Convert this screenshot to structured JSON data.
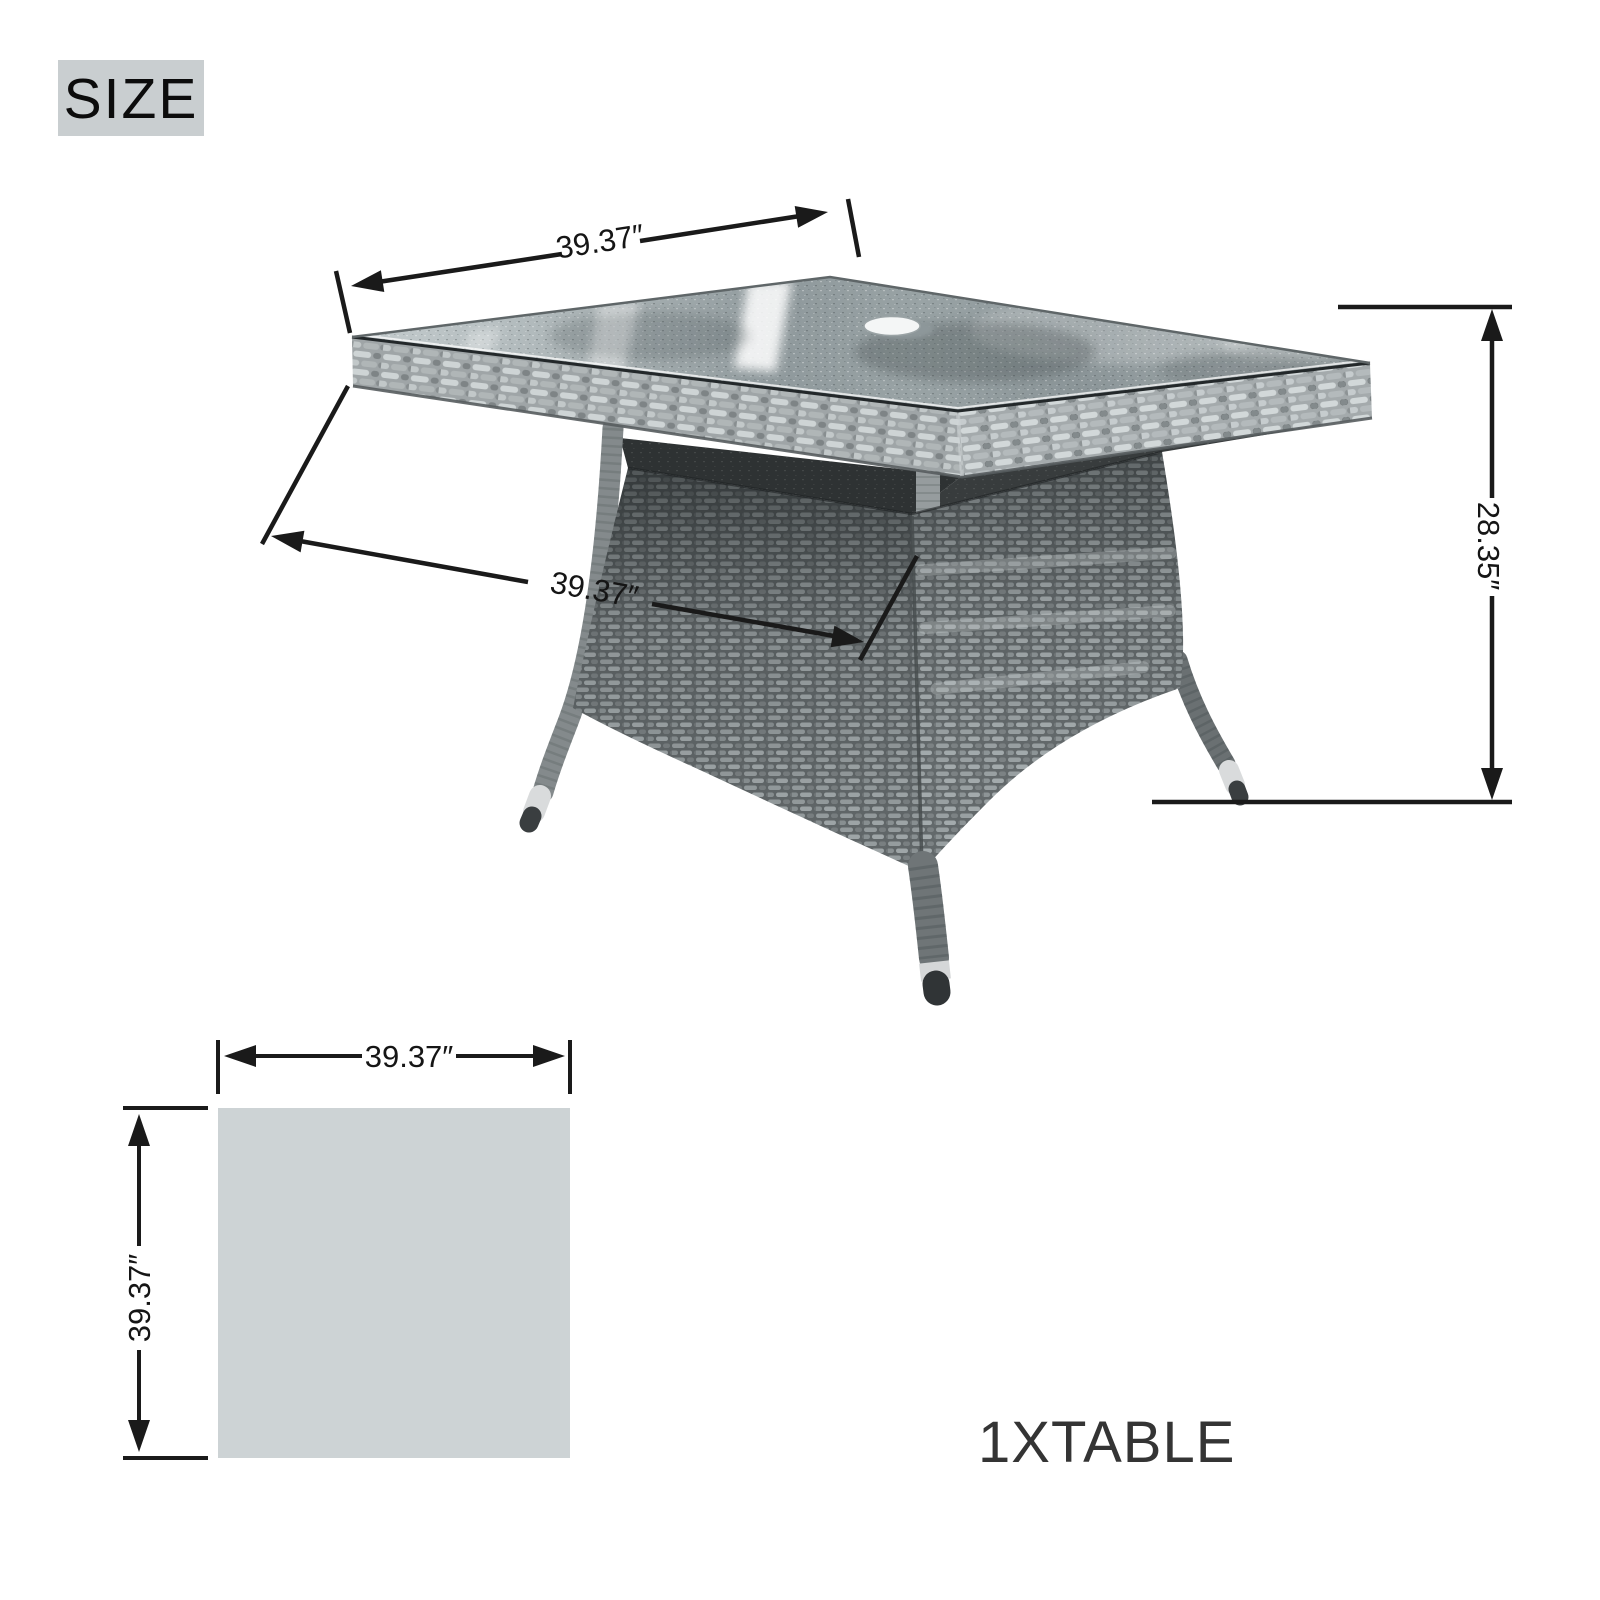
{
  "badge": {
    "label": "SIZE"
  },
  "product": {
    "note": "1XTABLE"
  },
  "dimensions": {
    "table_width": "39.37″",
    "table_depth": "39.37″",
    "table_height": "28.35″",
    "plan_width": "39.37″",
    "plan_depth": "39.37″"
  },
  "colors": {
    "dimension_lines": "#1a1a1a",
    "badge_background": "#c9ced0",
    "plan_square_fill": "#cdd3d5",
    "wicker_light": "#b6bcbd",
    "wicker_mid": "#8a9092",
    "wicker_dark": "#5b6163",
    "glass_mid": "#97a1a4",
    "foot_cap": "#d9dbdc"
  }
}
